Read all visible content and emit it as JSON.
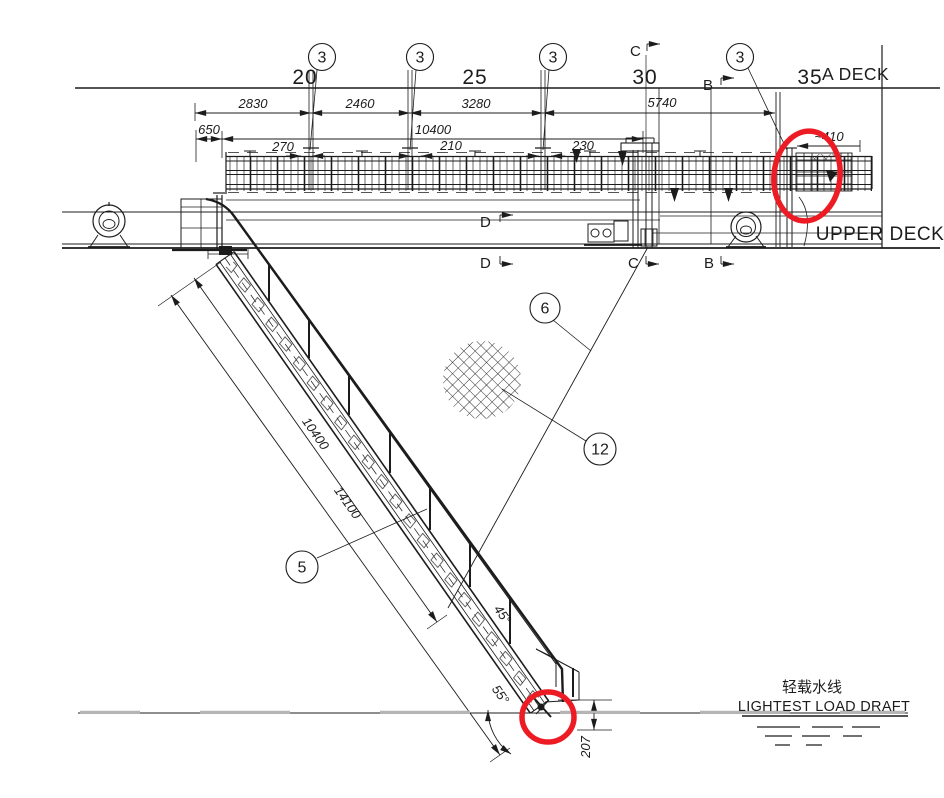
{
  "frames": [
    "20",
    "25",
    "30",
    "35"
  ],
  "decks": {
    "a_deck": "A DECK",
    "upper_deck": "UPPER DECK"
  },
  "sections": {
    "c_top": "C",
    "b_top": "B",
    "d_top": "D",
    "d_bottom": "D",
    "c_bottom": "C",
    "b_bottom": "B"
  },
  "balloons": {
    "b3_1": "3",
    "b3_2": "3",
    "b3_3": "3",
    "b3_4": "3",
    "b5": "5",
    "b6": "6",
    "b12": "12"
  },
  "dims": {
    "d2830": "2830",
    "d2460": "2460",
    "d3280": "3280",
    "d5740": "5740",
    "d650": "650",
    "d10400_top": "10400",
    "d270": "270",
    "d210": "210",
    "d230": "230",
    "d410": "~410",
    "d10400_ladder": "10400",
    "d14100": "14100",
    "d207": "207",
    "angle_55": "55°",
    "angle_45": "45°"
  },
  "waterline": {
    "label_zh": "轻载水线",
    "label_en": "LIGHTEST LOAD DRAFT"
  },
  "colors": {
    "highlight": "#ed1c24"
  }
}
